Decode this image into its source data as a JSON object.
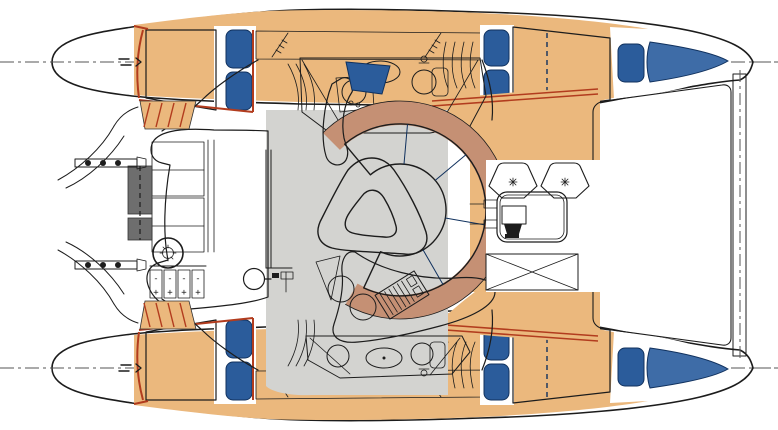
{
  "diagram": {
    "type": "boat-deck-plan",
    "subject": "catamaran layout, top view",
    "colors": {
      "outline": "#1c1c1c",
      "deck": "#EBB87D",
      "berth_blue": "#2B5C9B",
      "berth_edge": "#10315E",
      "bow_mattress_blue": "#3E6CA7",
      "table_orange": "#D2612D",
      "backrest_brown": "#C59074",
      "desk_brown": "#C69480",
      "floor_gray": "#D3D3D0",
      "steps_dark_gray": "#6E6E6E",
      "accent_red": "#B23C1E",
      "winch_gray": "#9A9A9A",
      "centerline_gray": "#555555",
      "canvas": "#FFFFFF"
    },
    "marks": {
      "minus": "-",
      "plus": "+"
    },
    "components": [
      "port-hull",
      "starboard-hull",
      "double-berth",
      "pillows",
      "bow-berth",
      "trampoline-net",
      "forward-crossbeam",
      "saloon-sofa",
      "saloon-table",
      "chaise-bench",
      "nav-desk",
      "chart-plotter",
      "bathroom",
      "galley-sink",
      "toilet",
      "forward-cockpit-table",
      "deck-seat",
      "storage-locker",
      "helm-station",
      "engine-controls",
      "winch",
      "transom-steps",
      "boarding-rail",
      "davit-lines",
      "side-deck",
      "companionway-steps"
    ]
  }
}
